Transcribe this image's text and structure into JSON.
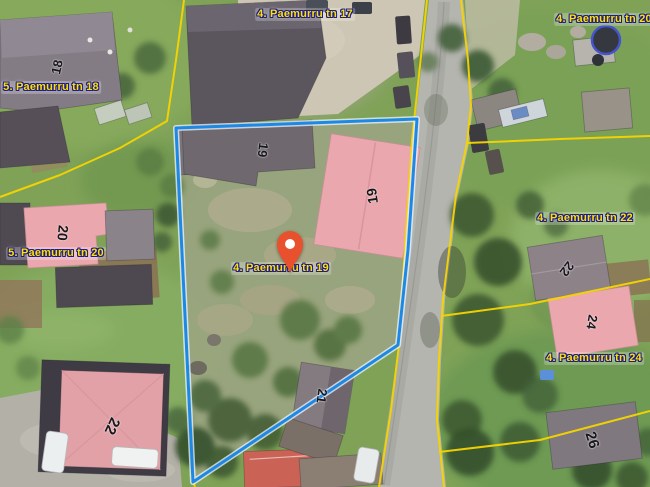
{
  "map": {
    "address_labels": [
      {
        "text": "4. Paemurru tn 17"
      },
      {
        "text": "4. Paemurru tn 20"
      },
      {
        "text": "5. Paemurru tn 18"
      },
      {
        "text": "5. Paemurru tn 20"
      },
      {
        "text": "4. Paemurru tn 19"
      },
      {
        "text": "4. Paemurru tn 22"
      },
      {
        "text": "4. Paemurru tn 24"
      }
    ],
    "building_numbers": [
      {
        "text": "18"
      },
      {
        "text": "19"
      },
      {
        "text": "19"
      },
      {
        "text": "20"
      },
      {
        "text": "21"
      },
      {
        "text": "22"
      },
      {
        "text": "22"
      },
      {
        "text": "24"
      },
      {
        "text": "26"
      }
    ],
    "icons": {
      "pin": "location-pin-icon"
    },
    "colors": {
      "parcel_outline": "#1e88e5",
      "cadastral_line": "#f5d400",
      "label_text": "#ffe100",
      "label_outline": "#1c1c8f",
      "highlight_roof": "#eaa7ad",
      "pin": "#e8502e"
    }
  }
}
